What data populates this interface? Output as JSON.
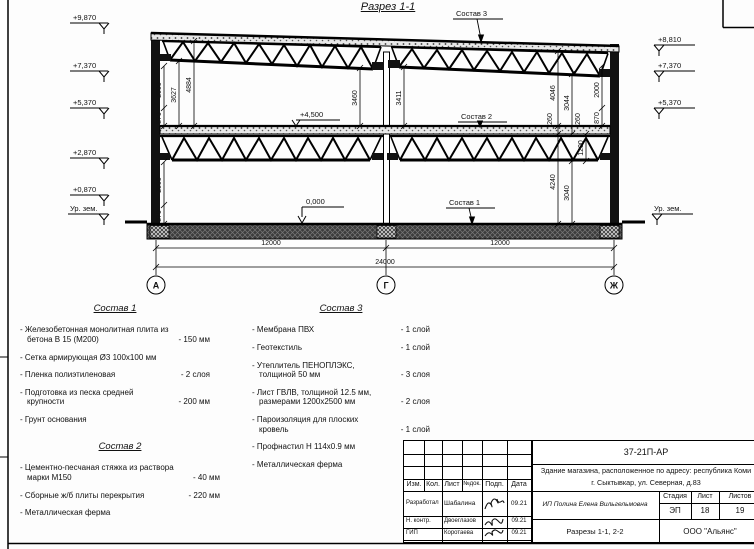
{
  "drawing": {
    "title": "Разрез 1-1",
    "elev_left": [
      "+9,870",
      "+7,370",
      "+5,370",
      "+2,870",
      "+0,870"
    ],
    "elev_right": [
      "+8,810",
      "+7,370",
      "+5,370"
    ],
    "ground_label": "Ур. зем.",
    "marks": {
      "upper_floor": "+4,500",
      "ground_floor": "0,000"
    },
    "refs": {
      "s1": "Состав 1",
      "s2": "Состав 2",
      "s3": "Состав 3"
    },
    "dims": {
      "upper_left": [
        "2000",
        "870",
        "3627",
        "4884"
      ],
      "center": [
        "3460",
        "3411"
      ],
      "upper_right": [
        "4046",
        "260",
        "3044",
        "260",
        "2000",
        "870"
      ],
      "lower_left": [
        "2000",
        "870"
      ],
      "lower_right": [
        "4240",
        "3040",
        "1200"
      ],
      "span_left": "12000",
      "span_right": "12000",
      "total": "24000"
    },
    "axes": [
      "А",
      "Г",
      "Ж"
    ]
  },
  "legend": {
    "s1": {
      "title": "Состав 1",
      "items": [
        {
          "name": "- Железобетонная  монолитная плита из бетона В 15 (М200)",
          "value": "- 150 мм"
        },
        {
          "name": "- Сетка армирующая Ø3 100х100 мм",
          "value": ""
        },
        {
          "name": "- Пленка полиэтиленовая",
          "value": "-  2 слоя"
        },
        {
          "name": "- Подготовка из песка средней крупности",
          "value": "- 200 мм"
        },
        {
          "name": "- Грунт основания",
          "value": ""
        }
      ]
    },
    "s2": {
      "title": "Состав 2",
      "items": [
        {
          "name": "- Цементно-песчаная стяжка из раствора марки М150",
          "value": "- 40 мм"
        },
        {
          "name": "- Сборные ж/б плиты перекрытия",
          "value": "- 220 мм"
        },
        {
          "name": "- Металлическая ферма",
          "value": ""
        }
      ]
    },
    "s3": {
      "title": "Состав 3",
      "items": [
        {
          "name": "- Мембрана ПВХ",
          "value": "- 1 слой"
        },
        {
          "name": "- Геотекстиль",
          "value": "- 1 слой"
        },
        {
          "name": "- Утеплитель ПЕНОПЛЭКС, толщиной 50 мм",
          "value": "- 3 слоя"
        },
        {
          "name": "- Лист ГВЛВ, толщиной 12.5 мм, размерами 1200х2500 мм",
          "value": "- 2 слоя"
        },
        {
          "name": "- Пароизоляция для плоских кровель",
          "value": "- 1 слой"
        },
        {
          "name": "- Профнастил Н 114х0.9 мм",
          "value": ""
        },
        {
          "name": "- Металлическая ферма",
          "value": ""
        }
      ]
    }
  },
  "titleblock": {
    "code": "37-21П-АР",
    "object_line1": "Здание магазина, расположенное по адресу: республика Коми",
    "object_line2": "г. Сыктывкар, ул. Северная, д.83",
    "cols": [
      "Изм.",
      "Кол.",
      "Лист",
      "№док.",
      "Подп.",
      "Дата"
    ],
    "rows": [
      {
        "role": "Разработал",
        "name": "Шабалина",
        "date": "09.21"
      },
      {
        "role": "Н. контр.",
        "name": "Двоеглазов",
        "date": "09.21"
      },
      {
        "role": "ГИП",
        "name": "Коротаева",
        "date": "09.21"
      }
    ],
    "designer": "ИП Полина Елена Вильгельмовна",
    "stage_label": "Стадия",
    "sheet_label": "Лист",
    "sheets_label": "Листов",
    "stage": "ЭП",
    "sheet": "18",
    "sheets": "19",
    "sheet_name": "Разрезы 1-1, 2-2",
    "company": "ООО \"Альянс\""
  }
}
